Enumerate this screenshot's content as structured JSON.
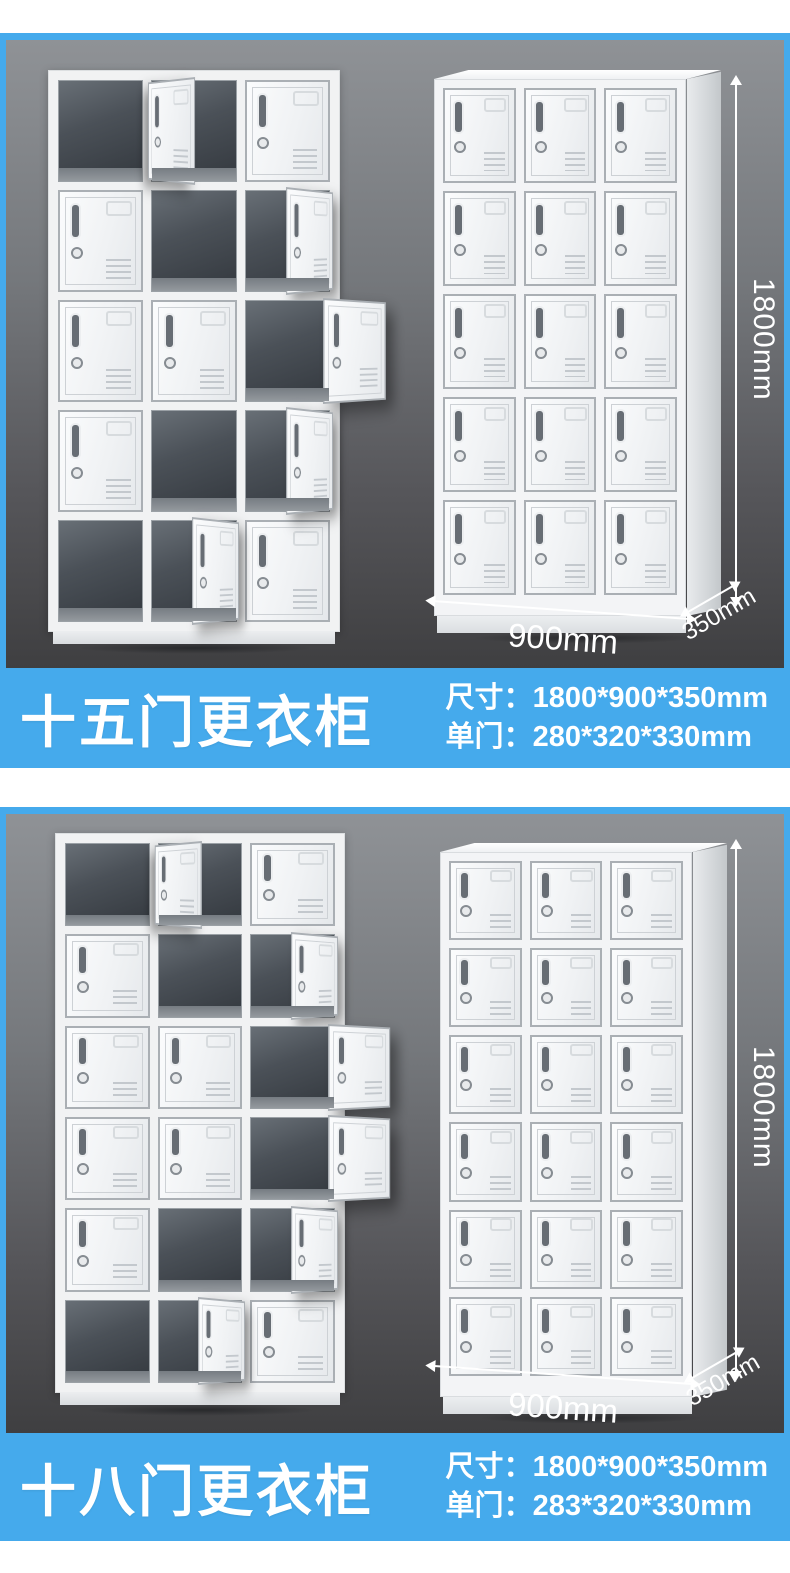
{
  "page": {
    "background": "#ffffff"
  },
  "colors": {
    "accent_blue": "#45aaec",
    "stage_gradient_top": "#8f9296",
    "stage_gradient_bottom": "#3f3f41",
    "banner_text": "#ffffff",
    "dimension_text": "#ffffff",
    "locker_white": "#f3f4f6",
    "cavity_dark": "#33383e"
  },
  "sections": [
    {
      "name": "15-door locker",
      "title": "十五门更衣柜",
      "spec_size_label": "尺寸：",
      "spec_size_value": "1800*900*350mm",
      "spec_door_label": "单门：",
      "spec_door_value": "280*320*330mm",
      "dim_height": "1800mm",
      "dim_width": "900mm",
      "dim_depth": "350mm",
      "open_locker": {
        "cols": 3,
        "rows": 5,
        "cells": [
          "open",
          "ajar-m",
          "closed",
          "closed",
          "open",
          "ajar",
          "closed",
          "closed",
          "ajar-out",
          "closed",
          "open",
          "ajar",
          "open",
          "ajar",
          "closed"
        ]
      },
      "closed_locker": {
        "cols": 3,
        "rows": 5,
        "doors": 15
      }
    },
    {
      "name": "18-door locker",
      "title": "十八门更衣柜",
      "spec_size_label": "尺寸：",
      "spec_size_value": "1800*900*350mm",
      "spec_door_label": "单门：",
      "spec_door_value": "283*320*330mm",
      "dim_height": "1800mm",
      "dim_width": "900mm",
      "dim_depth": "350mm",
      "open_locker": {
        "cols": 3,
        "rows": 6,
        "cells": [
          "open",
          "ajar-m",
          "closed",
          "closed",
          "open",
          "ajar",
          "closed",
          "closed",
          "ajar-out",
          "closed",
          "closed",
          "ajar-out",
          "closed",
          "open",
          "ajar",
          "open",
          "ajar",
          "closed"
        ]
      },
      "closed_locker": {
        "cols": 3,
        "rows": 6,
        "doors": 18
      }
    }
  ]
}
